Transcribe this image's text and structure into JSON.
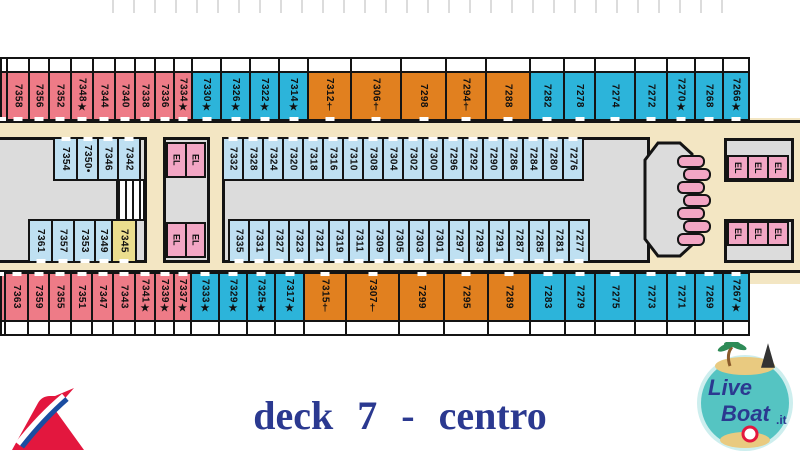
{
  "title": "deck 7 - centro",
  "colors": {
    "pink": "#EE7B87",
    "cyan": "#2CB4DA",
    "orange": "#E1801F",
    "lightblue": "#BFE0F2",
    "yellow": "#EBDE8E",
    "elevator_pink": "#F2A6C4",
    "gray": "#DCDCDC",
    "beige": "#F3E6C3",
    "line": "#141414",
    "title_blue": "#2B3990",
    "logo_teal": "#55C4C2",
    "logo_sand": "#E9CA80",
    "logo_red": "#E3173E",
    "logo_blue": "#1B4DA1"
  },
  "rows": {
    "top_outer": [
      {
        "n": "",
        "c": "pink",
        "w": 8
      },
      {
        "n": "7358",
        "c": "pink",
        "w": 24
      },
      {
        "n": "7356",
        "c": "pink",
        "w": 22
      },
      {
        "n": "7352",
        "c": "pink",
        "w": 24
      },
      {
        "n": "7348",
        "s": "★",
        "c": "pink",
        "w": 24
      },
      {
        "n": "7344",
        "c": "pink",
        "w": 24
      },
      {
        "n": "7340",
        "c": "pink",
        "w": 22
      },
      {
        "n": "7338",
        "c": "pink",
        "w": 22
      },
      {
        "n": "7336",
        "c": "pink",
        "w": 21
      },
      {
        "n": "7334",
        "s": "★",
        "c": "pink",
        "w": 20
      },
      {
        "n": "7330",
        "s": "★",
        "c": "cyan",
        "w": 31
      },
      {
        "n": "7326",
        "s": "★",
        "c": "cyan",
        "w": 31
      },
      {
        "n": "7322",
        "s": "★",
        "c": "cyan",
        "w": 31
      },
      {
        "n": "7314",
        "s": "★",
        "c": "cyan",
        "w": 31
      },
      {
        "n": "7312",
        "s": "†",
        "c": "orange",
        "w": 45
      },
      {
        "n": "7306",
        "s": "†",
        "c": "orange",
        "w": 52
      },
      {
        "n": "7298",
        "c": "orange",
        "w": 47
      },
      {
        "n": "7294",
        "s": "†",
        "c": "orange",
        "w": 42
      },
      {
        "n": "7288",
        "c": "orange",
        "w": 46
      },
      {
        "n": "7282",
        "c": "cyan",
        "w": 36
      },
      {
        "n": "7278",
        "c": "cyan",
        "w": 33
      },
      {
        "n": "7274",
        "c": "cyan",
        "w": 42
      },
      {
        "n": "7272",
        "c": "cyan",
        "w": 34
      },
      {
        "n": "7270",
        "s": "★",
        "c": "cyan",
        "w": 30
      },
      {
        "n": "7268",
        "c": "cyan",
        "w": 30
      },
      {
        "n": "7266",
        "s": "★",
        "c": "cyan",
        "w": 28
      }
    ],
    "top_inner": [
      {
        "n": "7332",
        "c": "lightblue",
        "w": 22
      },
      {
        "n": "7328",
        "c": "lightblue",
        "w": 22
      },
      {
        "n": "7324",
        "c": "lightblue",
        "w": 22
      },
      {
        "n": "7320",
        "c": "lightblue",
        "w": 22
      },
      {
        "n": "7318",
        "c": "lightblue",
        "w": 22
      },
      {
        "n": "7316",
        "c": "lightblue",
        "w": 22
      },
      {
        "n": "7310",
        "c": "lightblue",
        "w": 22
      },
      {
        "n": "7308",
        "c": "lightblue",
        "w": 22
      },
      {
        "n": "7304",
        "c": "lightblue",
        "w": 22
      },
      {
        "n": "7302",
        "c": "lightblue",
        "w": 22
      },
      {
        "n": "7300",
        "c": "lightblue",
        "w": 22
      },
      {
        "n": "7296",
        "c": "lightblue",
        "w": 22
      },
      {
        "n": "7292",
        "c": "lightblue",
        "w": 22
      },
      {
        "n": "7290",
        "c": "lightblue",
        "w": 22
      },
      {
        "n": "7286",
        "c": "lightblue",
        "w": 22
      },
      {
        "n": "7284",
        "c": "lightblue",
        "w": 22
      },
      {
        "n": "7280",
        "c": "lightblue",
        "w": 22
      },
      {
        "n": "7276",
        "c": "lightblue",
        "w": 22
      }
    ],
    "bottom_inner": [
      {
        "n": "7335",
        "c": "lightblue",
        "w": 22
      },
      {
        "n": "7331",
        "c": "lightblue",
        "w": 22
      },
      {
        "n": "7327",
        "c": "lightblue",
        "w": 22
      },
      {
        "n": "7323",
        "c": "lightblue",
        "w": 22
      },
      {
        "n": "7321",
        "c": "lightblue",
        "w": 22
      },
      {
        "n": "7319",
        "c": "lightblue",
        "w": 22
      },
      {
        "n": "7311",
        "c": "lightblue",
        "w": 22
      },
      {
        "n": "7309",
        "c": "lightblue",
        "w": 22
      },
      {
        "n": "7305",
        "c": "lightblue",
        "w": 22
      },
      {
        "n": "7303",
        "c": "lightblue",
        "w": 22
      },
      {
        "n": "7301",
        "c": "lightblue",
        "w": 22
      },
      {
        "n": "7297",
        "c": "lightblue",
        "w": 22
      },
      {
        "n": "7293",
        "c": "lightblue",
        "w": 22
      },
      {
        "n": "7291",
        "c": "lightblue",
        "w": 22
      },
      {
        "n": "7287",
        "c": "lightblue",
        "w": 22
      },
      {
        "n": "7285",
        "c": "lightblue",
        "w": 22
      },
      {
        "n": "7281",
        "c": "lightblue",
        "w": 22
      },
      {
        "n": "7277",
        "c": "lightblue",
        "w": 22
      }
    ],
    "left_island_top": [
      {
        "n": "7354",
        "c": "lightblue",
        "w": 25
      },
      {
        "n": "7350",
        "s": "•",
        "c": "lightblue",
        "w": 23
      },
      {
        "n": "7346",
        "c": "lightblue",
        "w": 22
      },
      {
        "n": "7342",
        "c": "lightblue",
        "w": 24
      }
    ],
    "left_island_bottom": [
      {
        "n": "7361",
        "c": "lightblue",
        "w": 25
      },
      {
        "n": "7357",
        "c": "lightblue",
        "w": 24
      },
      {
        "n": "7353",
        "c": "lightblue",
        "w": 23
      },
      {
        "n": "7349",
        "c": "lightblue",
        "w": 19
      },
      {
        "n": "7345",
        "c": "yellow",
        "w": 26
      }
    ],
    "bottom_outer": [
      {
        "n": "",
        "c": "pink",
        "w": 6
      },
      {
        "n": "7363",
        "c": "pink",
        "w": 25
      },
      {
        "n": "7359",
        "c": "pink",
        "w": 23
      },
      {
        "n": "7355",
        "c": "pink",
        "w": 24
      },
      {
        "n": "7351",
        "c": "pink",
        "w": 23
      },
      {
        "n": "7347",
        "c": "pink",
        "w": 23
      },
      {
        "n": "7343",
        "c": "pink",
        "w": 24
      },
      {
        "n": "7341",
        "s": "★",
        "c": "pink",
        "w": 22
      },
      {
        "n": "7339",
        "s": "★",
        "c": "pink",
        "w": 21
      },
      {
        "n": "7337",
        "s": "★",
        "c": "pink",
        "w": 19
      },
      {
        "n": "7333",
        "s": "★",
        "c": "cyan",
        "w": 30
      },
      {
        "n": "7329",
        "s": "★",
        "c": "cyan",
        "w": 30
      },
      {
        "n": "7325",
        "s": "★",
        "c": "cyan",
        "w": 30
      },
      {
        "n": "7317",
        "s": "★",
        "c": "cyan",
        "w": 31
      },
      {
        "n": "7315",
        "s": "†",
        "c": "orange",
        "w": 44
      },
      {
        "n": "7307",
        "s": "†",
        "c": "orange",
        "w": 55
      },
      {
        "n": "7299",
        "c": "orange",
        "w": 47
      },
      {
        "n": "7295",
        "c": "orange",
        "w": 46
      },
      {
        "n": "7289",
        "c": "orange",
        "w": 44
      },
      {
        "n": "7283",
        "c": "cyan",
        "w": 37
      },
      {
        "n": "7279",
        "c": "cyan",
        "w": 32
      },
      {
        "n": "7275",
        "c": "cyan",
        "w": 42
      },
      {
        "n": "7273",
        "c": "cyan",
        "w": 34
      },
      {
        "n": "7271",
        "c": "cyan",
        "w": 30
      },
      {
        "n": "7269",
        "c": "cyan",
        "w": 30
      },
      {
        "n": "7267",
        "s": "★",
        "c": "cyan",
        "w": 28
      }
    ]
  },
  "elevators": {
    "left_top": [
      "EL",
      "EL"
    ],
    "left_bottom": [
      "EL",
      "EL"
    ],
    "right_top": [
      "EL",
      "EL",
      "EL"
    ],
    "right_bottom": [
      "EL",
      "EL",
      "EL"
    ]
  },
  "logos": {
    "liveboat": {
      "word1": "Live",
      "word2": "Boat",
      "tld": ".it"
    }
  }
}
